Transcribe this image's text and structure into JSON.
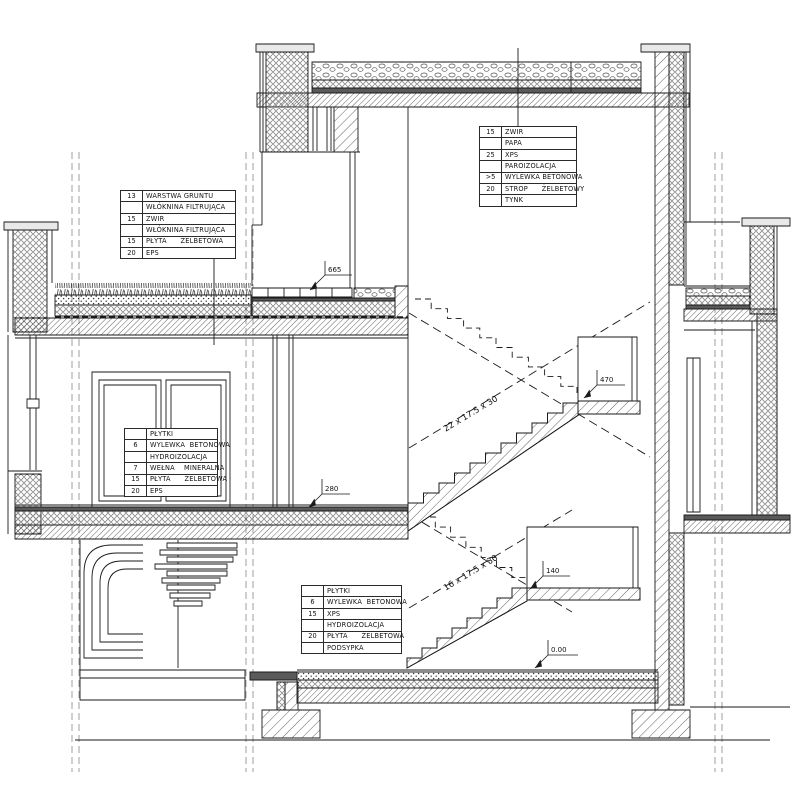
{
  "tables": {
    "roof": {
      "rows": [
        [
          "15",
          "ZWIR"
        ],
        [
          "",
          "PAPA"
        ],
        [
          "25",
          "XPS"
        ],
        [
          "",
          "PAROIZOLACJA"
        ],
        [
          ">5",
          "WYLEWKA BETONOWA"
        ],
        [
          "20",
          "STROP      ŻELBETOWY"
        ],
        [
          "",
          "TYNK"
        ]
      ]
    },
    "green_roof": {
      "rows": [
        [
          "13",
          "WARSTWA GRUNTU"
        ],
        [
          "",
          "WŁÓKNINA FILTRUJĄCA"
        ],
        [
          "15",
          "ZWIR"
        ],
        [
          "",
          "WŁÓKNINA FILTRUJĄCA"
        ],
        [
          "15",
          "PŁYTA      ŻELBETOWA"
        ],
        [
          "20",
          "EPS"
        ]
      ]
    },
    "floor_mid": {
      "rows": [
        [
          "",
          "PŁYTKI"
        ],
        [
          "6",
          "WYLEWKA  BETONOWA"
        ],
        [
          "",
          "HYDROIZOLACJA"
        ],
        [
          "7",
          "WEŁNA    MINERALNA"
        ],
        [
          "15",
          "PŁYTA      ŻELBETOWA"
        ],
        [
          "20",
          "EPS"
        ]
      ]
    },
    "floor_ground": {
      "rows": [
        [
          "",
          "PŁYTKI"
        ],
        [
          "6",
          "WYLEWKA  BETONOWA"
        ],
        [
          "15",
          "XPS"
        ],
        [
          "",
          "HYDROIZOLACJA"
        ],
        [
          "20",
          "PŁYTA      ŻELBETOWA"
        ],
        [
          "",
          "PODSYPKA"
        ]
      ]
    }
  },
  "levels": {
    "terrace": "665",
    "landing_470": "470",
    "floor_280": "280",
    "landing_140": "140",
    "ground": "0.00"
  },
  "stairs": {
    "upper_flight": "22 x 17.5 x 30",
    "lower_flight": "16 x 17.5 x 30"
  },
  "colors": {
    "line": "#1a1a1a",
    "dark_fill": "#5a5a5a",
    "coping_fill": "#e9e9e9"
  }
}
